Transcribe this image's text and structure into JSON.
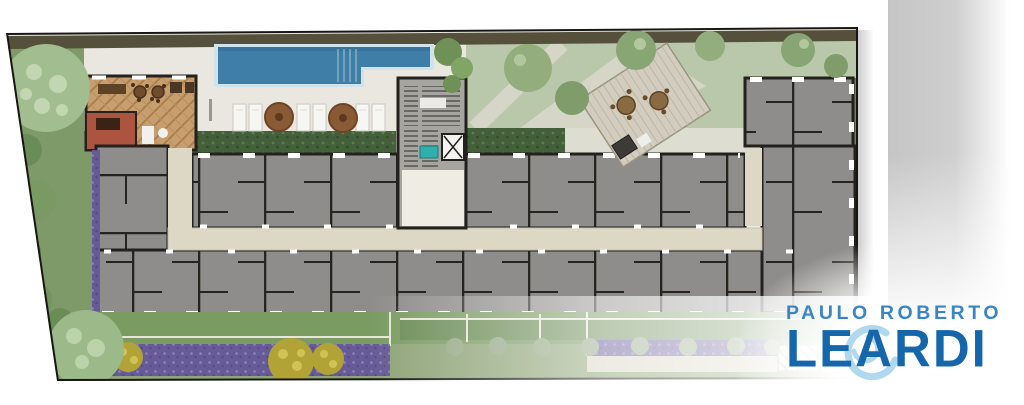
{
  "brand": {
    "name_line1": "PAULO ROBERTO",
    "name_line2": "LEARDI",
    "line1_color": "#3a85c4",
    "line2_color": "#1566ab",
    "emblem": "swirl-monogram-icon",
    "emblem_color": "#a8d4ee"
  },
  "plan": {
    "kind": "residential-condominium-site-floor-plan",
    "areas": [
      {
        "name": "swimming-pool",
        "color": "#3f7ea7"
      },
      {
        "name": "pool-deck",
        "color": "#e9e7e0"
      },
      {
        "name": "sun-loungers",
        "color": "#f6f6f3"
      },
      {
        "name": "deck-umbrellas",
        "color": "#8a5a35"
      },
      {
        "name": "party-room-wood-floor",
        "color": "#c79f6e"
      },
      {
        "name": "service-room-terracotta",
        "color": "#ac5440"
      },
      {
        "name": "apartment-units",
        "color": "#8e8d8b"
      },
      {
        "name": "interior-walls",
        "color": "#23211e"
      },
      {
        "name": "central-corridor",
        "color": "#ddd7c5"
      },
      {
        "name": "stair-elevator-core",
        "color": "#a7a5a0"
      },
      {
        "name": "garden-lawn",
        "color": "#7a9b62"
      },
      {
        "name": "rear-garden",
        "color": "#b9c7ab"
      },
      {
        "name": "hedge-strips",
        "color": "#44603a"
      },
      {
        "name": "lavender-flower-beds",
        "color": "#675b97"
      },
      {
        "name": "yellow-shrubs",
        "color": "#b1a336"
      },
      {
        "name": "trees",
        "color": "#9bb989"
      },
      {
        "name": "entrance-hatched-paving",
        "color": "#f3f1ea"
      },
      {
        "name": "site-boundary",
        "color": "#191714"
      }
    ]
  }
}
